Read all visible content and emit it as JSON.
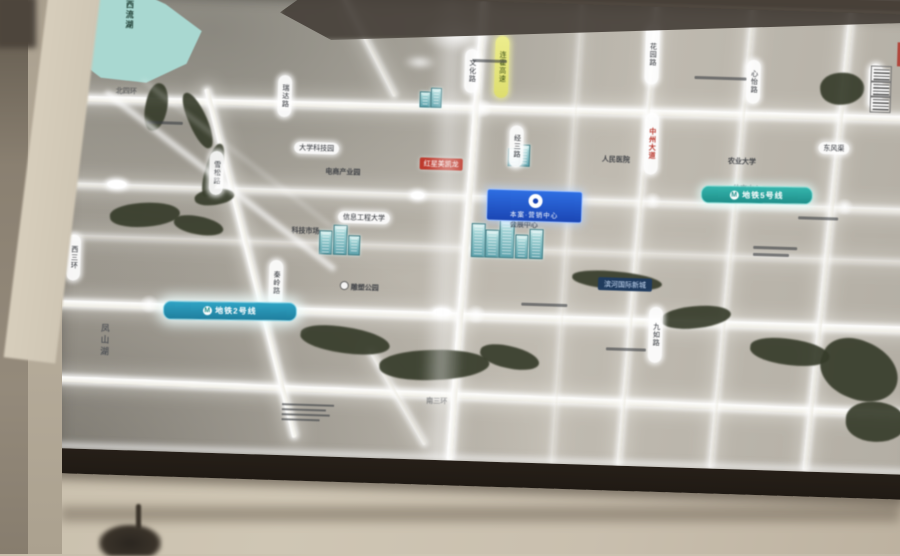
{
  "scene": {
    "panel": "backlit-area-map-display"
  },
  "map": {
    "lake": "西流湖",
    "district": "凤山湖",
    "metro_line_2": "地铁2号线",
    "metro_line_5": "地铁5号线",
    "metro_logo": "M",
    "marker": {
      "title": "本案·营销中心"
    },
    "roads_v": [
      "西三环",
      "秦岭路",
      "文化路",
      "连霍高速",
      "花园路",
      "心怡路",
      "中州大道",
      "九如路",
      "东三环",
      "瑞达路",
      "雪松路",
      "经三路"
    ],
    "pois": [
      "大学科技园",
      "电商产业园",
      "红星美凯龙",
      "信息工程大学",
      "科技市场",
      "会展中心",
      "人民医院",
      "农业大学",
      "体育中心",
      "雕塑公园",
      "滨河国际新城",
      "东风渠",
      "南三环",
      "北四环"
    ],
    "colors": {
      "metro_teal": "#2aa79f",
      "metro_blue": "#2b96b8",
      "marker_blue": "#2058c8",
      "highway_yellow": "#e3e37a",
      "poi_red": "#bd3a2d",
      "navy_label": "#1d3a5f",
      "lake_teal": "#a9d8d1",
      "park_green": "#363b2a",
      "road_glow": "#ffffff",
      "frame_wood": "#3a2d21",
      "wall_beige": "#c9bfae"
    }
  }
}
